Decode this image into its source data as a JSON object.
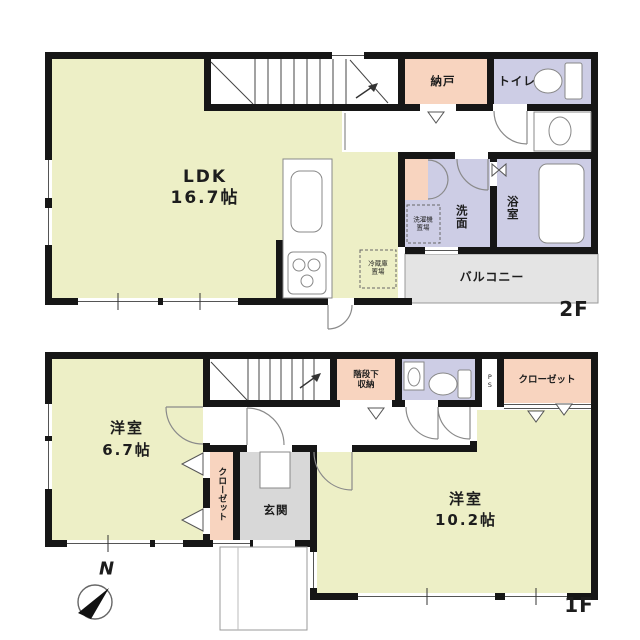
{
  "floor2": {
    "floor_label": "2F",
    "ldk_name": "LDK",
    "ldk_size": "16.7帖",
    "nando": "納戸",
    "toilet": "トイレ",
    "washroom": "洗面",
    "bathroom": "浴室",
    "balcony": "バルコニー",
    "washer_place": "洗濯機\n置場",
    "fridge_place": "冷蔵庫\n置場"
  },
  "floor1": {
    "floor_label": "1F",
    "room1_name": "洋室",
    "room1_size": "6.7帖",
    "room2_name": "洋室",
    "room2_size": "10.2帖",
    "under_stairs": "階段下\n収納",
    "closet_top": "クローゼット",
    "closet_side": "クローゼット",
    "entrance": "玄関",
    "pipe_space": "PS"
  },
  "compass_north": "N",
  "colors": {
    "wall": "#161616",
    "room_yellow": "#EDEFC6",
    "room_pink": "#F8D4BF",
    "room_lavender": "#CDCDE5",
    "balcony_gray": "#E4E4E4",
    "entrance_gray": "#D8D8D8"
  }
}
